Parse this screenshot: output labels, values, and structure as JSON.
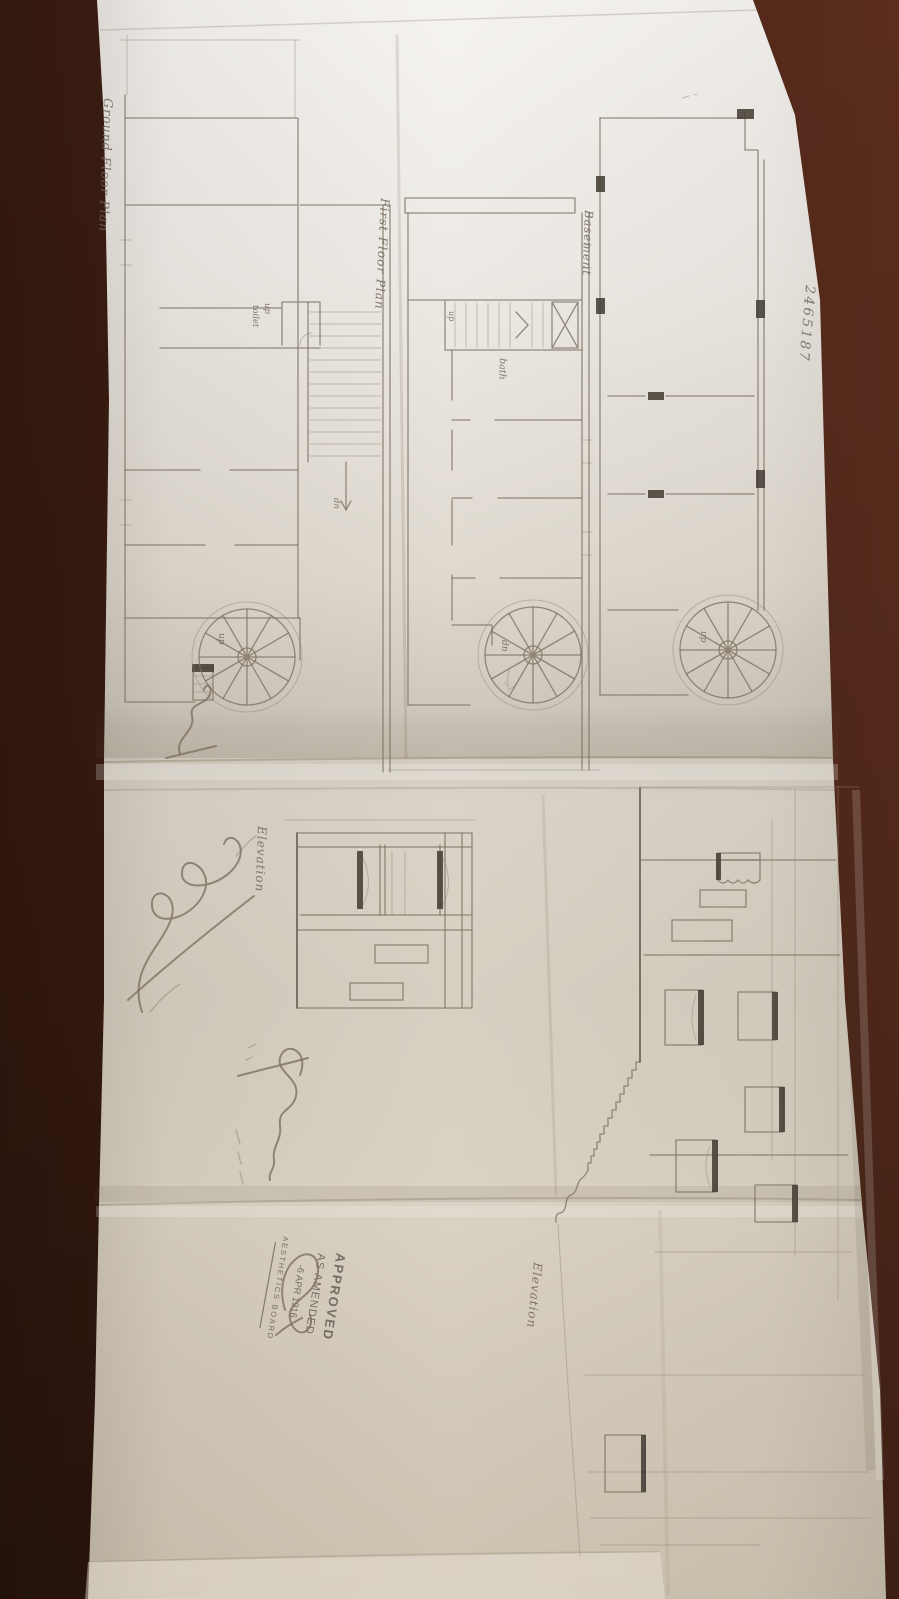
{
  "sheet": {
    "number": "2465187",
    "plans": [
      {
        "label": "Ground Floor Plan"
      },
      {
        "label": "First Floor Plan"
      },
      {
        "label": "Basement"
      }
    ],
    "elevations": [
      {
        "label": "Elevation"
      },
      {
        "label": "Elevation"
      }
    ],
    "annotations": {
      "up": "up",
      "toilet": "toilet",
      "dn": "dn",
      "bath": "bath"
    },
    "stamp": {
      "line1": "APPROVED",
      "line2": "AS AMENDED",
      "date": "-6 APR 1916",
      "board": "AESTHETICS BOARD"
    },
    "colors": {
      "table_wood": "#472214",
      "paper_light": "#f3f1ed",
      "paper_shadow": "#cdc3b1",
      "pencil": "#7b7060",
      "graphite_dark": "#463f36",
      "stamp_ink": "#5f5852"
    }
  }
}
